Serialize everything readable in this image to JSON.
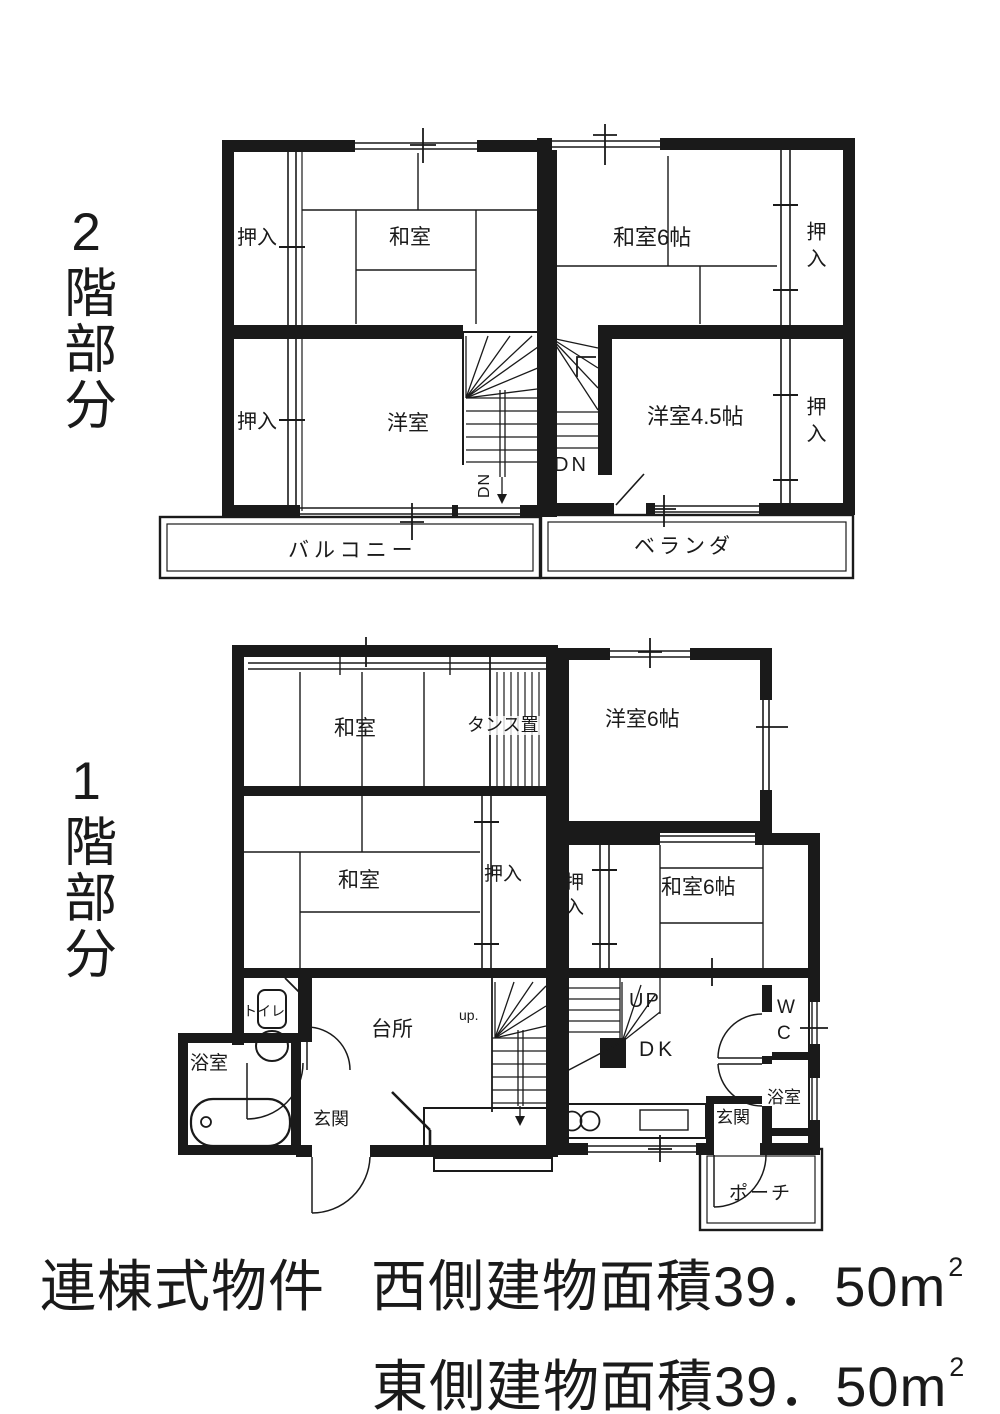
{
  "colors": {
    "ink": "#1a1a1a",
    "paper": "#ffffff"
  },
  "side_labels": {
    "floor2": "2階部分",
    "floor1": "1階部分"
  },
  "floor2": {
    "west": {
      "closet_top": "押入",
      "washitsu": "和室",
      "closet_bottom": "押入",
      "youshitsu": "洋室",
      "stairs_down": "DN",
      "balcony": "バルコニー"
    },
    "east": {
      "washitsu_6": "和室6帖",
      "closet_top": "押入",
      "youshitsu_45": "洋室4.5帖",
      "closet_bottom": "押入",
      "stairs_down": "DN",
      "veranda": "ベランダ"
    }
  },
  "floor1": {
    "west": {
      "washitsu_top": "和室",
      "tansu_oki": "タンス置",
      "washitsu_mid": "和室",
      "closet": "押入",
      "toilet": "トイレ",
      "bathroom": "浴室",
      "entrance": "玄関",
      "kitchen": "台所",
      "stairs_up": "up."
    },
    "east": {
      "youshitsu_6": "洋室6帖",
      "closet": "押入",
      "washitsu_6": "和室6帖",
      "stairs_up": "UP",
      "dining_kitchen": "DK",
      "wc": "WC",
      "bathroom": "浴室",
      "entrance": "玄関",
      "porch": "ポーチ"
    }
  },
  "footer": {
    "property_type": "連棟式物件",
    "west_area": "西側建物面積39．50m",
    "east_area": "東側建物面積39．50m",
    "area_sup": "2"
  }
}
